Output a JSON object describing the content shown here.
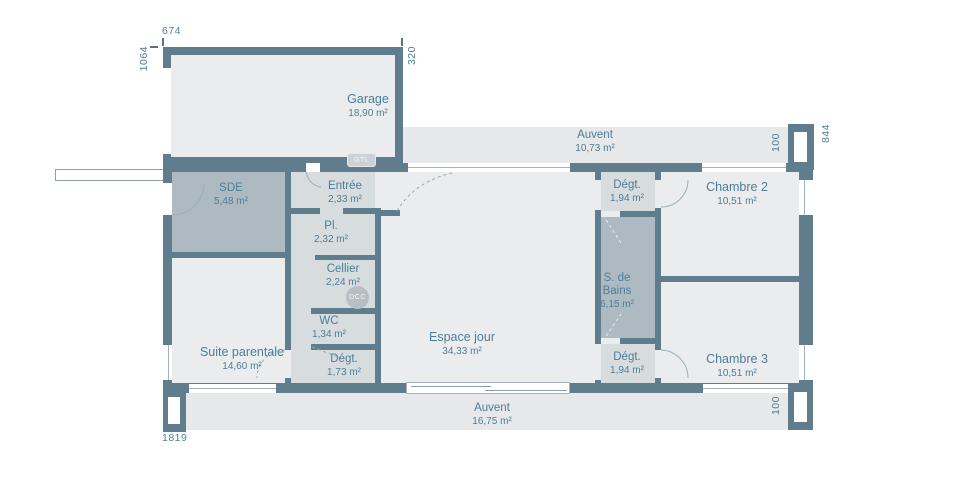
{
  "colors": {
    "wall": "#607d8d",
    "room": "#eaecee",
    "hall": "#d7dcdf",
    "wet": "#adbac2",
    "awning": "#e6e8ea",
    "label": "#4e7e96"
  },
  "dimensions": {
    "top": "674",
    "left": "1064",
    "garage_right": "320",
    "right": "844",
    "pillar_top": "100",
    "pillar_bottom": "100",
    "bottom": "1819"
  },
  "badges": {
    "gtl": "GTL",
    "dcc": "DCC"
  },
  "rooms": {
    "garage": {
      "name": "Garage",
      "area": "18,90 m²"
    },
    "auvent_top": {
      "name": "Auvent",
      "area": "10,73 m²"
    },
    "auvent_bottom": {
      "name": "Auvent",
      "area": "16,75 m²"
    },
    "sde": {
      "name": "SDE",
      "area": "5,48 m²"
    },
    "entree": {
      "name": "Entrée",
      "area": "2,33 m²"
    },
    "placard": {
      "name": "Pl.",
      "area": "2,32 m²"
    },
    "cellier": {
      "name": "Cellier",
      "area": "2,24 m²"
    },
    "wc": {
      "name": "WC",
      "area": "1,34 m²"
    },
    "degagement_sw": {
      "name": "Dégt.",
      "area": "1,73 m²"
    },
    "espace_jour": {
      "name": "Espace jour",
      "area": "34,33 m²"
    },
    "suite_parentale": {
      "name": "Suite parentale",
      "area": "14,60 m²"
    },
    "degagement_ne": {
      "name": "Dégt.",
      "area": "1,94 m²"
    },
    "salle_de_bains": {
      "l1": "S. de",
      "l2": "Bains",
      "area": "6,15 m²"
    },
    "degagement_se": {
      "name": "Dégt.",
      "area": "1,94 m²"
    },
    "chambre2": {
      "name": "Chambre 2",
      "area": "10,51 m²"
    },
    "chambre3": {
      "name": "Chambre 3",
      "area": "10,51 m²"
    }
  }
}
